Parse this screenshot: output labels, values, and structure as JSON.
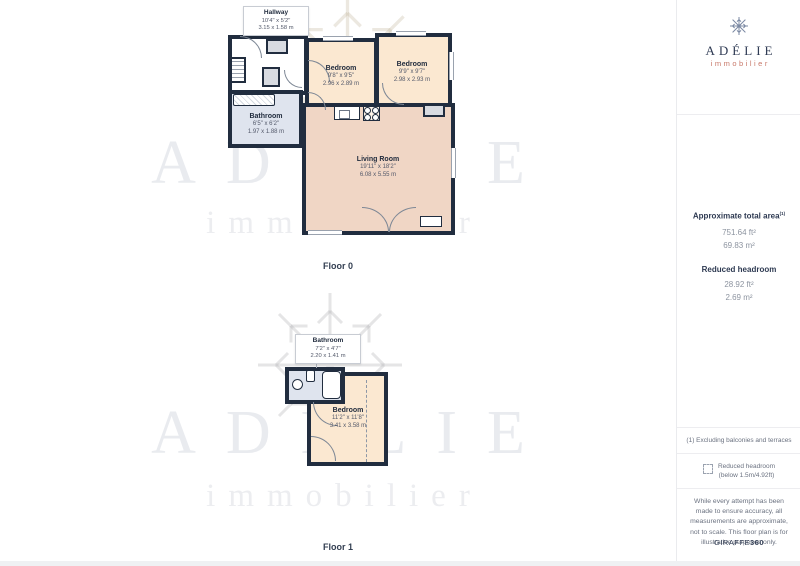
{
  "watermark": {
    "brand": "ADÉLIE",
    "sub": "immobilier"
  },
  "floor0": {
    "label": "Floor 0",
    "hallway": {
      "name": "Hallway",
      "imperial": "10'4\" x 5'2\"",
      "metric": "3.15 x 1.58 m"
    },
    "bathroom": {
      "name": "Bathroom",
      "imperial": "6'5\" x 6'2\"",
      "metric": "1.97 x 1.88 m"
    },
    "bedroom_left": {
      "name": "Bedroom",
      "imperial": "9'8\" x 9'5\"",
      "metric": "2.96 x 2.89 m"
    },
    "bedroom_right": {
      "name": "Bedroom",
      "imperial": "9'9\" x 9'7\"",
      "metric": "2.98 x 2.93 m"
    },
    "living_room": {
      "name": "Living Room",
      "imperial": "19'11\" x 18'2\"",
      "metric": "6.08 x 5.55 m"
    }
  },
  "floor1": {
    "label": "Floor 1",
    "bathroom": {
      "name": "Bathroom",
      "imperial": "7'2\" x 4'7\"",
      "metric": "2.20 x 1.41 m"
    },
    "bedroom": {
      "name": "Bedroom",
      "imperial": "11'2\" x 11'8\"",
      "metric": "3.41 x 3.58 m"
    }
  },
  "sidebar": {
    "logo": {
      "brand": "ADÉLIE",
      "sub": "immobilier"
    },
    "total_area": {
      "title": "Approximate total area",
      "sup": "(1)",
      "ft": "751.64 ft²",
      "m": "69.83 m²"
    },
    "reduced": {
      "title": "Reduced headroom",
      "ft": "28.92 ft²",
      "m": "2.69 m²"
    },
    "footnote": "(1) Excluding balconies and terraces",
    "legend": {
      "line1": "Reduced headroom",
      "line2": "(below 1.5m/4.92ft)"
    },
    "disclaimer": "While every attempt has been made to ensure accuracy, all measurements are approximate, not to scale. This floor plan is for illustrative purposes only.",
    "credit": {
      "brand": "GIRAFFE",
      "suffix": "360"
    }
  },
  "colors": {
    "wall": "#212d3f",
    "bedroom": "#fbe8d1",
    "living": "#f0d6c5",
    "bathroom": "#dfe4ee",
    "brand_navy": "#2f3b54",
    "brand_coral": "#c8796a"
  }
}
